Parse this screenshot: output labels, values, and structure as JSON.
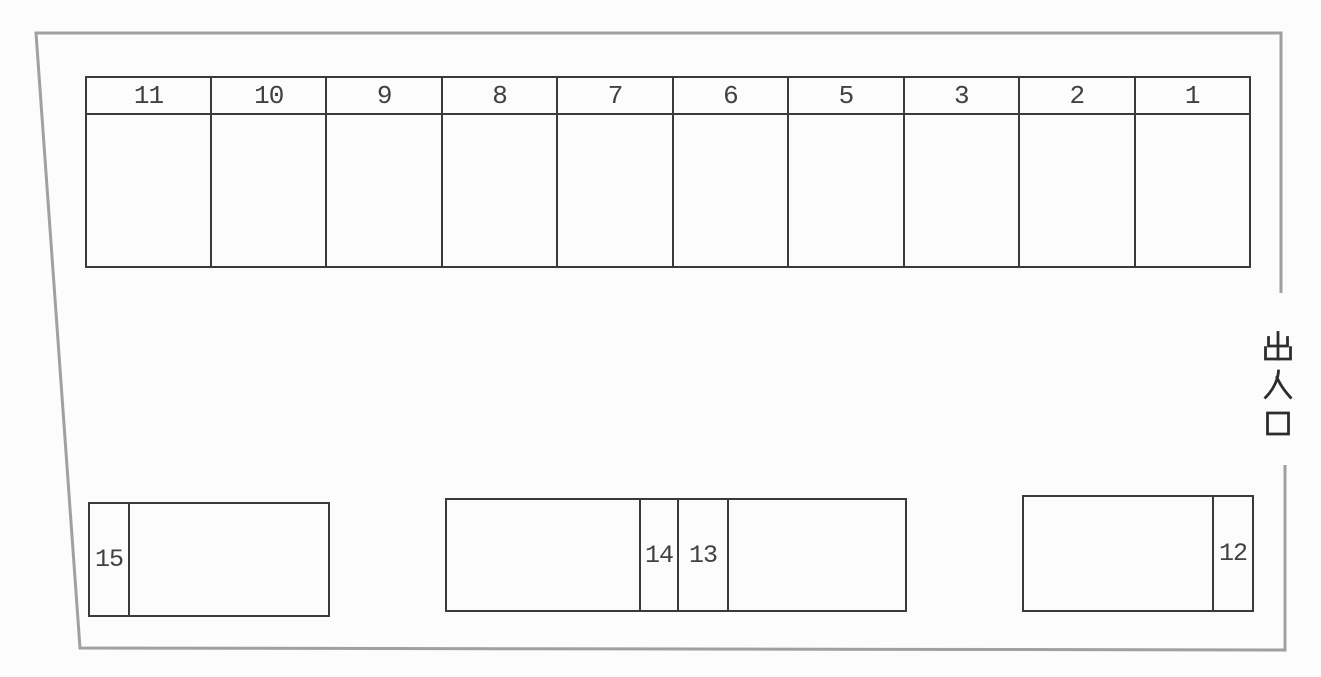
{
  "diagram_type": "parking-lot-layout",
  "entrance": {
    "label": "出入口"
  },
  "top_row": {
    "spaces": [
      "11",
      "10",
      "9",
      "8",
      "7",
      "6",
      "5",
      "3",
      "2",
      "1"
    ]
  },
  "bottom_row": {
    "left_box": {
      "label": "15"
    },
    "middle_box": {
      "label_left": "14",
      "label_right": "13"
    },
    "right_box": {
      "label": "12"
    }
  },
  "colors": {
    "boundary_line": "#a0a0a0",
    "stall_line": "#3a3a3a",
    "digits": "#414141",
    "background": "#fcfcfc"
  }
}
